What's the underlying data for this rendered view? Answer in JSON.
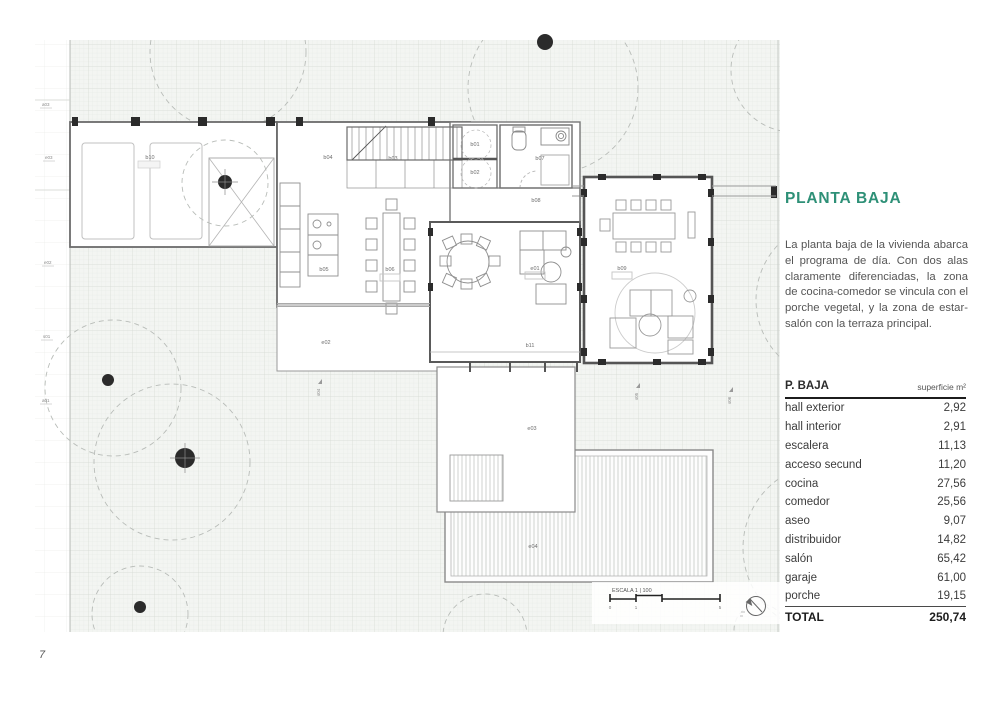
{
  "page": {
    "number": "7"
  },
  "panel": {
    "title": "PLANTA BAJA",
    "title_color": "#2E9077",
    "description": "La planta baja de la vivienda abarca el programa de día. Con dos alas claramente diferenciadas, la zona de cocina-comedor se vincula con el porche vegetal, y la zona de estar-salón con la terraza principal."
  },
  "table": {
    "header": {
      "name": "P. BAJA",
      "unit": "superficie m²"
    },
    "rows": [
      {
        "label": "hall exterior",
        "value": "2,92"
      },
      {
        "label": "hall interior",
        "value": "2,91"
      },
      {
        "label": "escalera",
        "value": "11,13"
      },
      {
        "label": "acceso secund",
        "value": "11,20"
      },
      {
        "label": "cocina",
        "value": "27,56"
      },
      {
        "label": "comedor",
        "value": "25,56"
      },
      {
        "label": "aseo",
        "value": "9,07"
      },
      {
        "label": "distribuidor",
        "value": "14,82"
      },
      {
        "label": "salón",
        "value": "65,42"
      },
      {
        "label": "garaje",
        "value": "61,00"
      },
      {
        "label": "porche",
        "value": "19,15"
      }
    ],
    "total": {
      "label": "TOTAL",
      "value": "250,74"
    }
  },
  "plan": {
    "labels": {
      "b01": "b01",
      "b02": "b02",
      "b03": "b03",
      "b04": "b04",
      "b05": "b05",
      "b06": "b06",
      "b07": "b07",
      "b08": "b08",
      "b09": "b09",
      "b10": "b10",
      "b11": "b11",
      "e01": "e01",
      "e02": "e02",
      "e03": "e03",
      "e04": "e04"
    },
    "edge_labels": {
      "l1": "a03",
      "l2": "e03",
      "l3": "e02",
      "l4": "s01",
      "l5": "a01",
      "f1": "s04",
      "f2": "s05",
      "f3": "s06"
    },
    "scale": {
      "label": "ESCALA 1 | 100",
      "t0": "0",
      "t1": "1",
      "t2": "5"
    }
  }
}
